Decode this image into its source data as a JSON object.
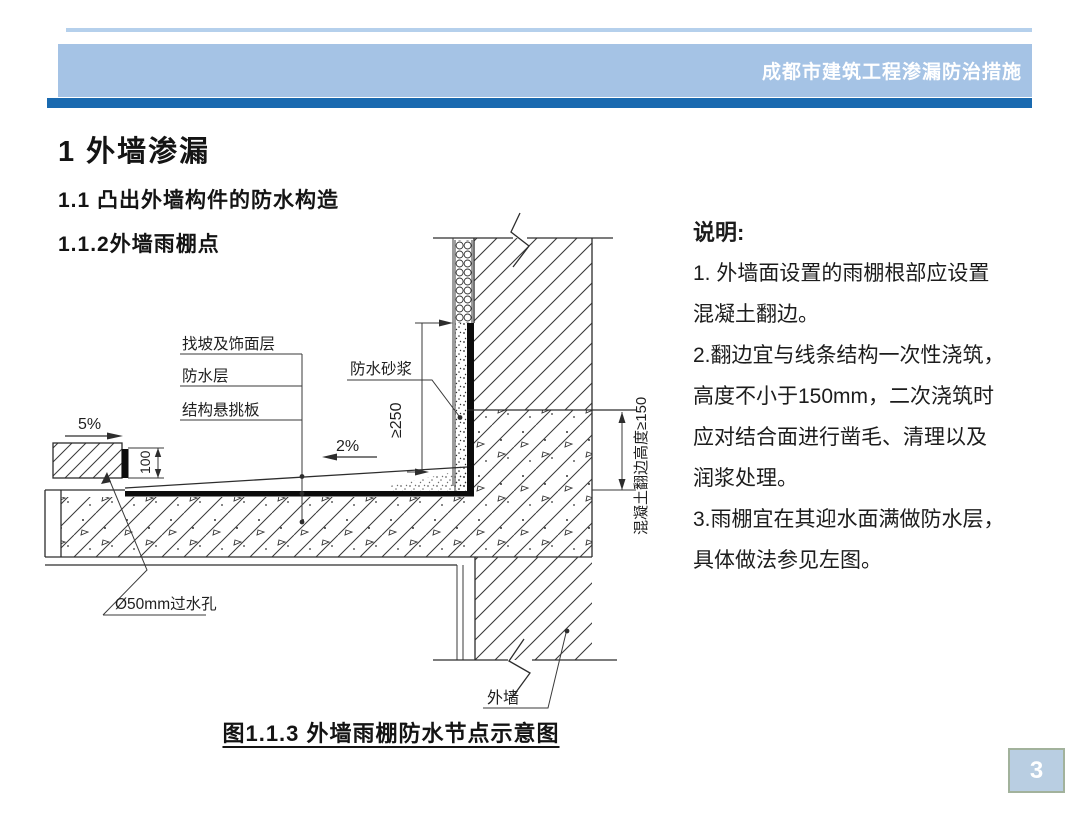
{
  "header": {
    "title": "成都市建筑工程渗漏防治措施"
  },
  "sections": {
    "h1": "1 外墙渗漏",
    "h2": "1.1 凸出外墙构件的防水构造",
    "h3": "1.1.2外墙雨棚点"
  },
  "notes": {
    "heading": "说明:",
    "lines": [
      "1. 外墙面设置的雨棚根部应设置",
      "混凝土翻边。",
      "2.翻边宜与线条结构一次性浇筑，",
      "高度不小于150mm，二次浇筑时",
      "应对结合面进行凿毛、清理以及",
      "润浆处理。",
      "3.雨棚宜在其迎水面满做防水层，",
      "具体做法参见左图。"
    ]
  },
  "figure": {
    "caption": "图1.1.3 外墙雨棚防水节点示意图"
  },
  "diagram": {
    "labels": {
      "edge_slope": "5%",
      "edge_height": "100",
      "drain_hole": "Ø50mm过水孔",
      "layer_slope_finish": "找坡及饰面层",
      "layer_waterproof": "防水层",
      "layer_slab": "结构悬挑板",
      "top_slope": "2%",
      "waterproof_mortar": "防水砂浆",
      "dim_upturn": "≥250",
      "dim_flange": "混凝土翻边高度≥150",
      "exterior_wall": "外墙"
    }
  },
  "page": {
    "number": "3"
  },
  "colors": {
    "header_band": "#a5c3e5",
    "accent_stripe": "#1a6ab0",
    "top_rule": "#b5d0ec",
    "page_badge_bg": "#b9cee2",
    "page_badge_border": "#a2b29c"
  }
}
